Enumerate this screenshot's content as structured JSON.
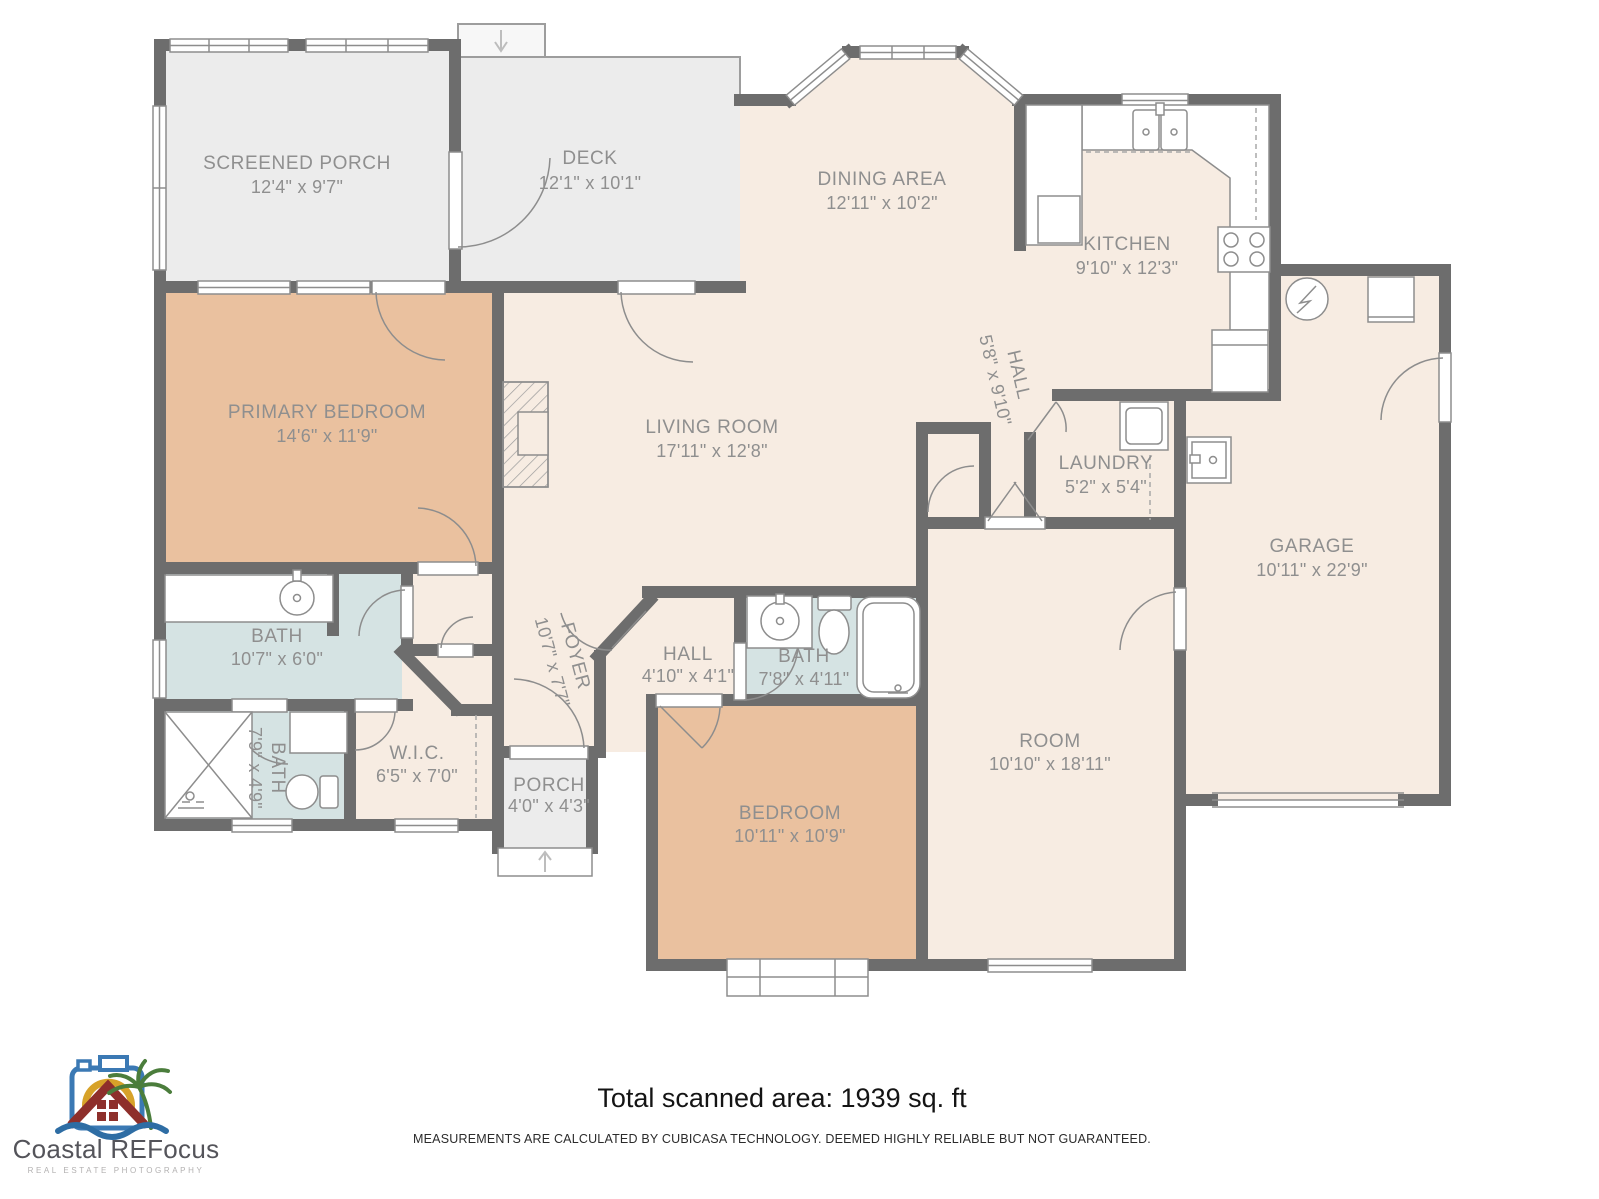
{
  "footer": {
    "total_area": "Total scanned area: 1939 sq. ft",
    "disclaimer": "MEASUREMENTS ARE CALCULATED BY CUBICASA TECHNOLOGY. DEEMED HIGHLY RELIABLE BUT NOT GUARANTEED."
  },
  "branding": {
    "company": "Coastal REFocus",
    "tagline": "REAL ESTATE PHOTOGRAPHY"
  },
  "colors": {
    "wall": "#6d6d6d",
    "floor": "#f7ece2",
    "bedroom_fill": "#eac19f",
    "bath_fill": "#d5e3e3",
    "outdoor_fill": "#ececec",
    "label_text": "#8f8f8f",
    "logo_blue": "#3b79b4",
    "logo_gold": "#d7a229",
    "logo_red": "#8e2f2b",
    "logo_green": "#4b7d3c",
    "logo_wave": "#2e6da4"
  },
  "rooms": [
    {
      "name": "SCREENED PORCH",
      "dims": "12'4\" x 9'7\""
    },
    {
      "name": "DECK",
      "dims": "12'1\" x 10'1\""
    },
    {
      "name": "DINING AREA",
      "dims": "12'11\" x 10'2\""
    },
    {
      "name": "KITCHEN",
      "dims": "9'10\" x 12'3\""
    },
    {
      "name": "HALL",
      "dims": "5'8\" x 9'10\""
    },
    {
      "name": "LAUNDRY",
      "dims": "5'2\" x 5'4\""
    },
    {
      "name": "GARAGE",
      "dims": "10'11\" x 22'9\""
    },
    {
      "name": "PRIMARY BEDROOM",
      "dims": "14'6\" x 11'9\""
    },
    {
      "name": "LIVING ROOM",
      "dims": "17'11\" x 12'8\""
    },
    {
      "name": "BATH",
      "dims": "10'7\" x 6'0\""
    },
    {
      "name": "BATH",
      "dims": "7'9\" x 4'9\""
    },
    {
      "name": "W.I.C.",
      "dims": "6'5\" x 7'0\""
    },
    {
      "name": "FOYER",
      "dims": "10'7\" x 7'7\""
    },
    {
      "name": "PORCH",
      "dims": "4'0\" x 4'3\""
    },
    {
      "name": "HALL",
      "dims": "4'10\" x 4'1\""
    },
    {
      "name": "BATH",
      "dims": "7'8\" x 4'11\""
    },
    {
      "name": "BEDROOM",
      "dims": "10'11\" x 10'9\""
    },
    {
      "name": "ROOM",
      "dims": "10'10\" x 18'11\""
    }
  ]
}
